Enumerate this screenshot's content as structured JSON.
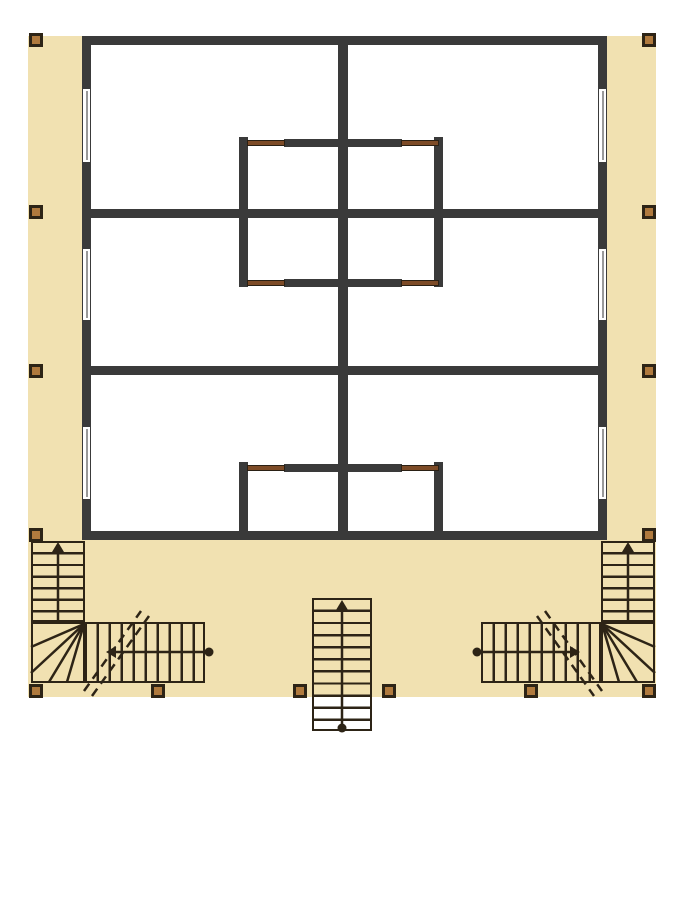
{
  "title": "duplex-floor-plan-drawing",
  "canvas": {
    "width": 691,
    "height": 900
  },
  "palette": {
    "background": "#ffffff",
    "deck": "#f1e1b1",
    "wall": "#3a3a3a",
    "interior": "#ffffff",
    "line": "#2d2416",
    "post_fill": "#b07a3e",
    "door": "#7d4b27",
    "window_fill": "#ffffff",
    "window_line": "#999999"
  },
  "deck": {
    "x": 28,
    "y": 36,
    "w": 628,
    "h": 661
  },
  "building": {
    "x": 82,
    "y": 36,
    "w": 525,
    "h": 504
  },
  "walls": [
    {
      "part": "exterior-top",
      "x": 82,
      "y": 36,
      "w": 525,
      "h": 9
    },
    {
      "part": "exterior-bottom",
      "x": 82,
      "y": 531,
      "w": 525,
      "h": 9
    },
    {
      "part": "exterior-left",
      "x": 82,
      "y": 36,
      "w": 9,
      "h": 504
    },
    {
      "part": "exterior-right",
      "x": 598,
      "y": 36,
      "w": 9,
      "h": 504
    },
    {
      "part": "center-spine",
      "x": 338,
      "y": 36,
      "w": 10,
      "h": 504
    },
    {
      "part": "cross-wall-upper",
      "x": 82,
      "y": 209,
      "w": 525,
      "h": 9
    },
    {
      "part": "cross-wall-lower",
      "x": 82,
      "y": 366,
      "w": 525,
      "h": 9
    },
    {
      "part": "upper-core-left",
      "x": 239,
      "y": 137,
      "w": 9,
      "h": 150
    },
    {
      "part": "upper-core-right",
      "x": 434,
      "y": 137,
      "w": 9,
      "h": 150
    },
    {
      "part": "upper-core-top-mid",
      "x": 284,
      "y": 139,
      "w": 118,
      "h": 8
    },
    {
      "part": "upper-core-bottom-mid",
      "x": 284,
      "y": 279,
      "w": 118,
      "h": 8
    },
    {
      "part": "lower-core-left",
      "x": 239,
      "y": 462,
      "w": 9,
      "h": 78
    },
    {
      "part": "lower-core-right",
      "x": 434,
      "y": 462,
      "w": 9,
      "h": 78
    },
    {
      "part": "lower-core-top-mid",
      "x": 284,
      "y": 464,
      "w": 118,
      "h": 8
    }
  ],
  "doors": [
    {
      "x": 247,
      "y": 140,
      "w": 38,
      "h": 6
    },
    {
      "x": 401,
      "y": 140,
      "w": 38,
      "h": 6
    },
    {
      "x": 247,
      "y": 280,
      "w": 38,
      "h": 6
    },
    {
      "x": 401,
      "y": 280,
      "w": 38,
      "h": 6
    },
    {
      "x": 247,
      "y": 465,
      "w": 38,
      "h": 6
    },
    {
      "x": 401,
      "y": 465,
      "w": 38,
      "h": 6
    }
  ],
  "windows": [
    {
      "x": 82,
      "y": 88,
      "w": 9,
      "h": 75
    },
    {
      "x": 82,
      "y": 248,
      "w": 9,
      "h": 73
    },
    {
      "x": 82,
      "y": 426,
      "w": 9,
      "h": 74
    },
    {
      "x": 598,
      "y": 88,
      "w": 9,
      "h": 75
    },
    {
      "x": 598,
      "y": 248,
      "w": 9,
      "h": 73
    },
    {
      "x": 598,
      "y": 426,
      "w": 9,
      "h": 74
    }
  ],
  "posts": [
    {
      "x": 29,
      "y": 33
    },
    {
      "x": 642,
      "y": 33
    },
    {
      "x": 29,
      "y": 205
    },
    {
      "x": 642,
      "y": 205
    },
    {
      "x": 29,
      "y": 364
    },
    {
      "x": 642,
      "y": 364
    },
    {
      "x": 29,
      "y": 528
    },
    {
      "x": 642,
      "y": 528
    },
    {
      "x": 29,
      "y": 684
    },
    {
      "x": 151,
      "y": 684
    },
    {
      "x": 293,
      "y": 684
    },
    {
      "x": 382,
      "y": 684
    },
    {
      "x": 524,
      "y": 684
    },
    {
      "x": 642,
      "y": 684
    }
  ],
  "stairs": {
    "runs": [
      {
        "x": 31,
        "y": 541,
        "w": 54,
        "h": 81,
        "orient": "v",
        "spacing": 11.6
      },
      {
        "x": 85,
        "y": 622,
        "w": 120,
        "h": 61,
        "orient": "h",
        "spacing": 12
      },
      {
        "x": 601,
        "y": 541,
        "w": 54,
        "h": 81,
        "orient": "v",
        "spacing": 11.6
      },
      {
        "x": 481,
        "y": 622,
        "w": 120,
        "h": 61,
        "orient": "h",
        "spacing": 12
      },
      {
        "x": 312,
        "y": 598,
        "w": 60,
        "h": 133,
        "orient": "v",
        "spacing": 12.1
      }
    ],
    "winders": [
      {
        "x": 31,
        "y": 622,
        "w": 54,
        "h": 61
      },
      {
        "x": 601,
        "y": 622,
        "w": 54,
        "h": 61
      }
    ],
    "fans": [
      {
        "pivot": [
          84,
          624
        ],
        "ends": [
          [
            31,
            647
          ],
          [
            31,
            673
          ],
          [
            49,
            682
          ],
          [
            67,
            682
          ]
        ]
      },
      {
        "pivot": [
          602,
          624
        ],
        "ends": [
          [
            655,
            647
          ],
          [
            655,
            673
          ],
          [
            637,
            682
          ],
          [
            619,
            682
          ]
        ]
      }
    ],
    "arrows": [
      {
        "stem": [
          [
            58,
            622
          ],
          [
            58,
            552
          ]
        ],
        "head": {
          "tip": [
            58,
            542
          ],
          "dir": "up"
        }
      },
      {
        "stem": [
          [
            205,
            652
          ],
          [
            114,
            652
          ]
        ],
        "head": {
          "tip": [
            106,
            652
          ],
          "dir": "left"
        },
        "dot": [
          209,
          652
        ]
      },
      {
        "stem": [
          [
            628,
            622
          ],
          [
            628,
            552
          ]
        ],
        "head": {
          "tip": [
            628,
            542
          ],
          "dir": "up"
        }
      },
      {
        "stem": [
          [
            481,
            652
          ],
          [
            572,
            652
          ]
        ],
        "head": {
          "tip": [
            580,
            652
          ],
          "dir": "right"
        },
        "dot": [
          477,
          652
        ]
      },
      {
        "stem": [
          [
            342,
            726
          ],
          [
            342,
            610
          ]
        ],
        "head": {
          "tip": [
            342,
            600
          ],
          "dir": "up"
        },
        "dot": [
          342,
          728
        ]
      }
    ],
    "breaks": [
      {
        "from": [
          84,
          691
        ],
        "to": [
          141,
          611
        ]
      },
      {
        "from": [
          92,
          696
        ],
        "to": [
          149,
          616
        ]
      },
      {
        "from": [
          545,
          611
        ],
        "to": [
          602,
          691
        ]
      },
      {
        "from": [
          537,
          616
        ],
        "to": [
          594,
          696
        ]
      }
    ],
    "dot_radius": 4.5,
    "line_width": 2.5
  }
}
